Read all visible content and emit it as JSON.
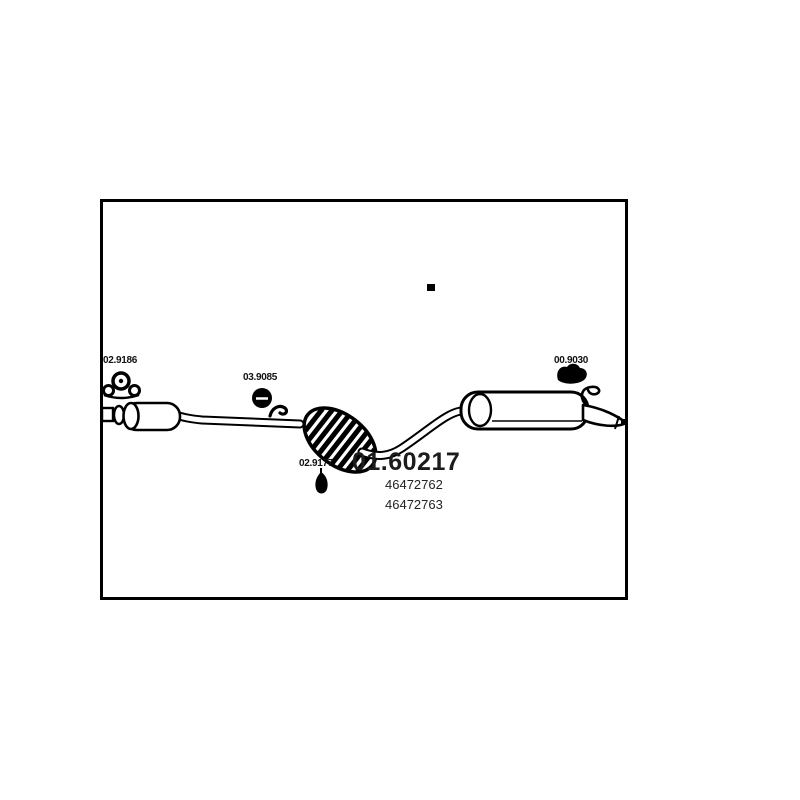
{
  "window": {
    "background": "#ffffff"
  },
  "diagram": {
    "part_number": "01.60217",
    "oe_numbers": {
      "primary": "46472762",
      "secondary": "46472763"
    },
    "mount_labels": {
      "front": "02.9186",
      "middle": "03.9085",
      "rear": "00.9030",
      "flex": "02.9177"
    },
    "colors": {
      "line": "#000000",
      "text": "#1c1c1c",
      "background": "#ffffff"
    }
  }
}
